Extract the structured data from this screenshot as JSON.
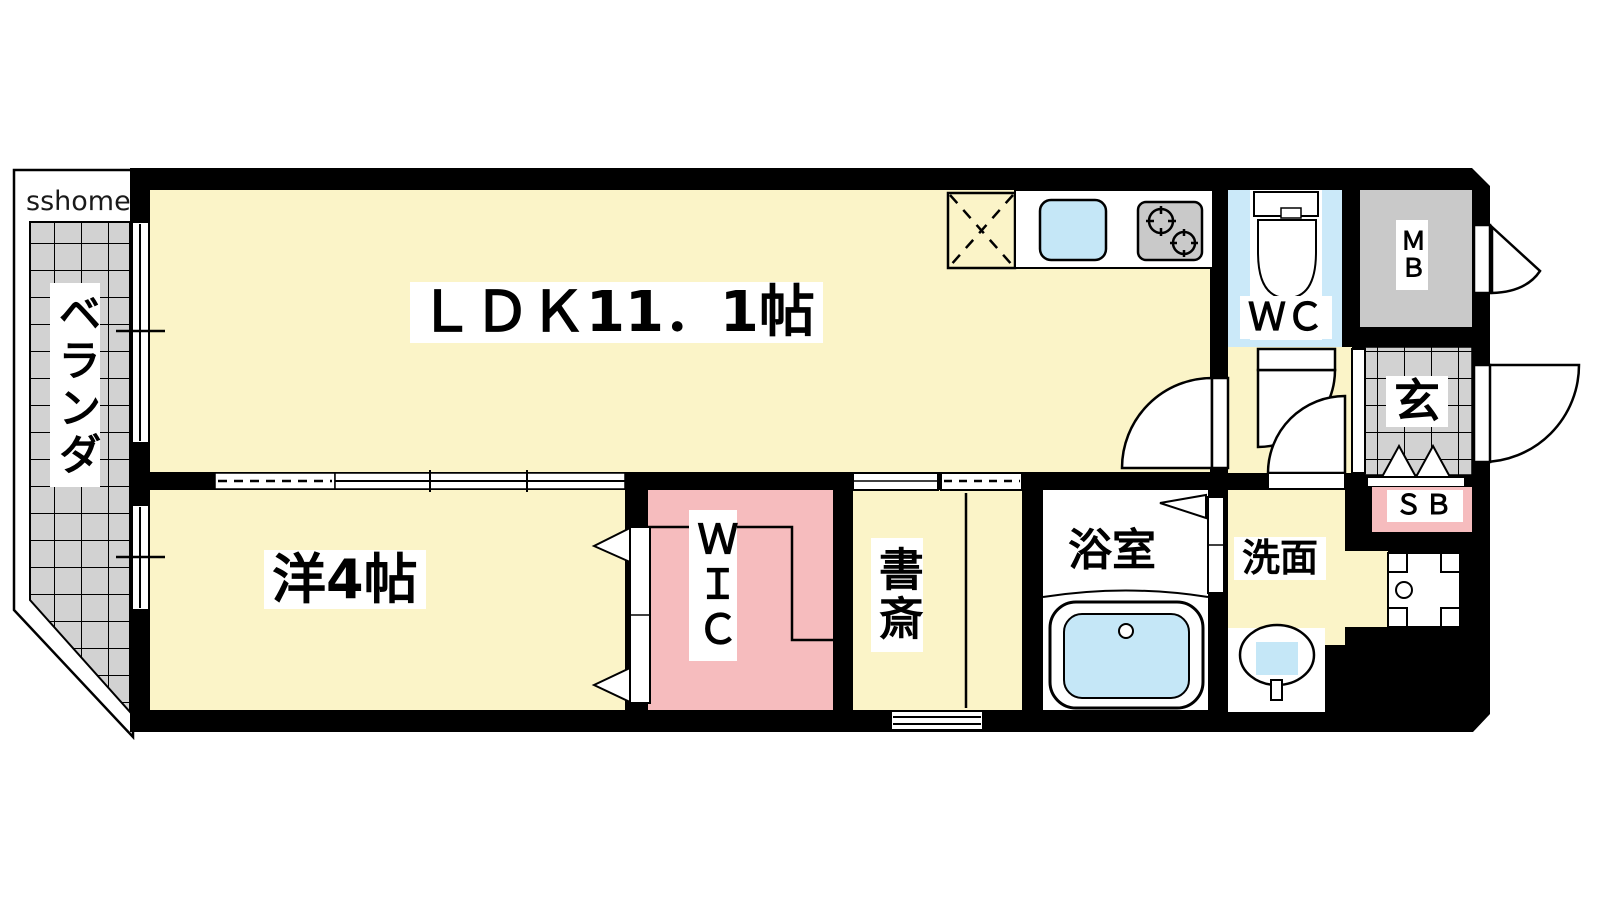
{
  "watermark": "sshome",
  "labels": {
    "veranda": "ベランダ",
    "ldk": "ＬＤＫ11．1帖",
    "western_room": "洋4帖",
    "wic": "ＷＩＣ",
    "study": "書斎",
    "bathroom": "浴室",
    "washroom": "洗面",
    "toilet": "ＷＣ",
    "entrance": "玄",
    "shoe_box": "ＳＢ",
    "meter_box": "ＭＢ"
  },
  "colors": {
    "floor_yellow": "#FBF4C8",
    "floor_pink": "#F6BCBE",
    "wc_blue": "#CBE9F9",
    "water_blue": "#C5E7F7",
    "tile_gray": "#D2D2D2",
    "fixture_gray": "#C9C9C9",
    "wall_black": "#000000",
    "floor_white": "#FFFFFF"
  }
}
